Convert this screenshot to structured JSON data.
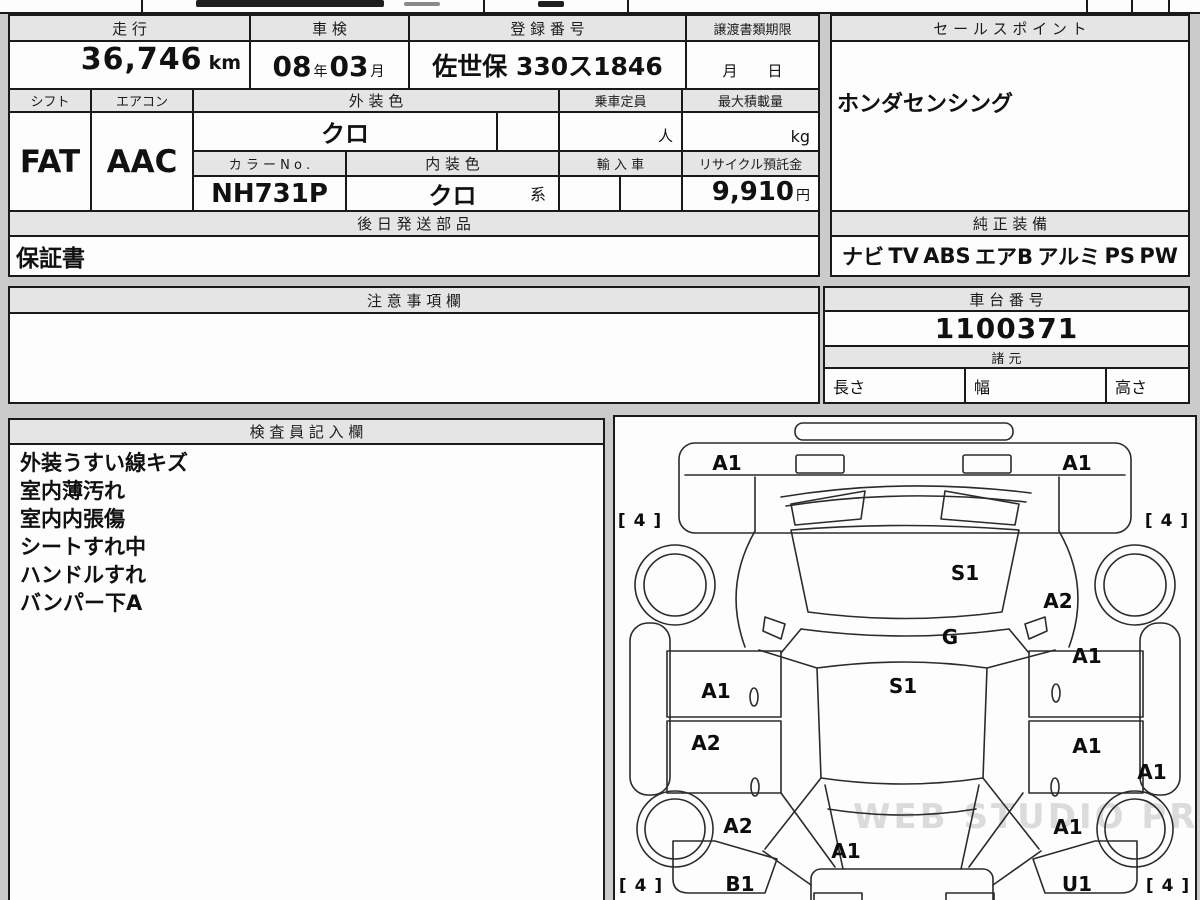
{
  "colors": {
    "page_bg": "#cbcbcb",
    "border": "#1a1a1a",
    "header_bg": "#e5e5e5",
    "cell_bg": "#fdfdfd"
  },
  "table1": {
    "mileage_label": "走 行",
    "mileage_value": "36,746",
    "mileage_unit": "km",
    "shaken_label": "車 検",
    "shaken_year": "08",
    "shaken_year_unit": "年",
    "shaken_month": "03",
    "shaken_month_unit": "月",
    "registration_label": "登 録 番 号",
    "registration_value": "佐世保 330ス1846",
    "transfer_label": "譲渡書類期限",
    "transfer_value": "月　　日",
    "shift_label": "シフト",
    "shift_value": "FAT",
    "aircon_label": "エアコン",
    "aircon_value": "AAC",
    "exterior_label": "外 装 色",
    "exterior_value": "クロ",
    "capacity_label": "乗車定員",
    "capacity_value": "",
    "capacity_unit": "人",
    "max_load_label": "最大積載量",
    "max_load_value": "",
    "max_load_unit": "kg",
    "color_no_label": "カ ラ ー N o .",
    "color_no_value": "NH731P",
    "interior_label": "内 装 色",
    "interior_value": "クロ",
    "interior_suffix": "系",
    "import_label": "輸 入 車",
    "import_value": "",
    "recycle_label": "リサイクル預託金",
    "recycle_value": "9,910",
    "recycle_unit": "円",
    "later_parts_label": "後 日 発 送 部 品",
    "later_parts_value": "保証書"
  },
  "sales_point": {
    "label": "セ ー ル ス ポ イ ン ト",
    "value": "ホンダセンシング"
  },
  "equipment": {
    "label": "純 正 装 備",
    "items": [
      "ナビ",
      "TV",
      "ABS",
      "エアB",
      "アルミ",
      "PS",
      "PW"
    ]
  },
  "notes": {
    "label": "注 意 事 項 欄",
    "value": ""
  },
  "chassis": {
    "label": "車 台 番 号",
    "value": "1100371"
  },
  "dimensions": {
    "label": "諸 元",
    "length_label": "長さ",
    "length_value": "",
    "width_label": "幅",
    "width_value": "",
    "height_label": "高さ",
    "height_value": ""
  },
  "inspector": {
    "label": "検 査 員 記 入 欄",
    "lines": [
      "外装うすい線キズ",
      "室内薄汚れ",
      "室内内張傷",
      "シートすれ中",
      "ハンドルすれ",
      "バンパー下A"
    ]
  },
  "diagram": {
    "watermark": "WEB STUDIO PRO",
    "labels": [
      {
        "code": "A1",
        "part": "front-bumper-left",
        "x": 112,
        "y": 46
      },
      {
        "code": "A1",
        "part": "front-bumper-right",
        "x": 462,
        "y": 46
      },
      {
        "code": "[ 4 ]",
        "part": "tire-front-left",
        "x": 25,
        "y": 104
      },
      {
        "code": "[ 4 ]",
        "part": "tire-front-right",
        "x": 552,
        "y": 104
      },
      {
        "code": "S1",
        "part": "windshield",
        "x": 350,
        "y": 156
      },
      {
        "code": "A2",
        "part": "right-front-fender",
        "x": 443,
        "y": 184
      },
      {
        "code": "G",
        "part": "cowl",
        "x": 335,
        "y": 220
      },
      {
        "code": "A1",
        "part": "right-front-door",
        "x": 472,
        "y": 239
      },
      {
        "code": "S1",
        "part": "roof",
        "x": 288,
        "y": 269
      },
      {
        "code": "A1",
        "part": "left-front-door",
        "x": 101,
        "y": 274
      },
      {
        "code": "A2",
        "part": "left-rear-door",
        "x": 91,
        "y": 326
      },
      {
        "code": "A1",
        "part": "right-rear-door",
        "x": 472,
        "y": 329
      },
      {
        "code": "A1",
        "part": "right-sill",
        "x": 537,
        "y": 355
      },
      {
        "code": "A2",
        "part": "left-quarter",
        "x": 123,
        "y": 409
      },
      {
        "code": "A1",
        "part": "tailgate",
        "x": 231,
        "y": 434
      },
      {
        "code": "A1",
        "part": "right-quarter",
        "x": 453,
        "y": 410
      },
      {
        "code": "B1",
        "part": "left-rear-corner",
        "x": 125,
        "y": 467
      },
      {
        "code": "U1",
        "part": "right-rear-corner",
        "x": 462,
        "y": 467
      },
      {
        "code": "[ 4 ]",
        "part": "tire-rear-left",
        "x": 26,
        "y": 469
      },
      {
        "code": "[ 4 ]",
        "part": "tire-rear-right",
        "x": 553,
        "y": 469
      }
    ]
  }
}
